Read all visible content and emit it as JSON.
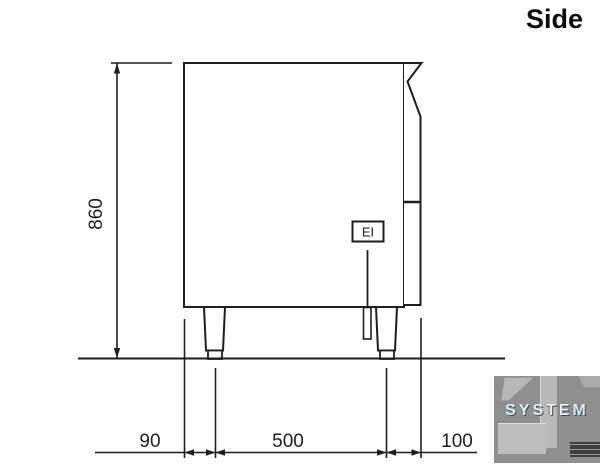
{
  "title": "Side",
  "diagram": {
    "type": "technical-side-elevation",
    "labels": {
      "connection": "EI"
    },
    "dimensions": {
      "height": {
        "label": "860",
        "value_mm": 860
      },
      "front_offset": {
        "label": "90",
        "value_mm": 90
      },
      "leg_spacing": {
        "label": "500",
        "value_mm": 500
      },
      "rear_offset": {
        "label": "100",
        "value_mm": 100
      }
    }
  },
  "watermark": {
    "text": "SYSTEM"
  },
  "colors": {
    "line": "#1e1e1e",
    "background": "#ffffff",
    "watermark_bg": "#8f8f8f",
    "watermark_text": "#dceef3"
  }
}
